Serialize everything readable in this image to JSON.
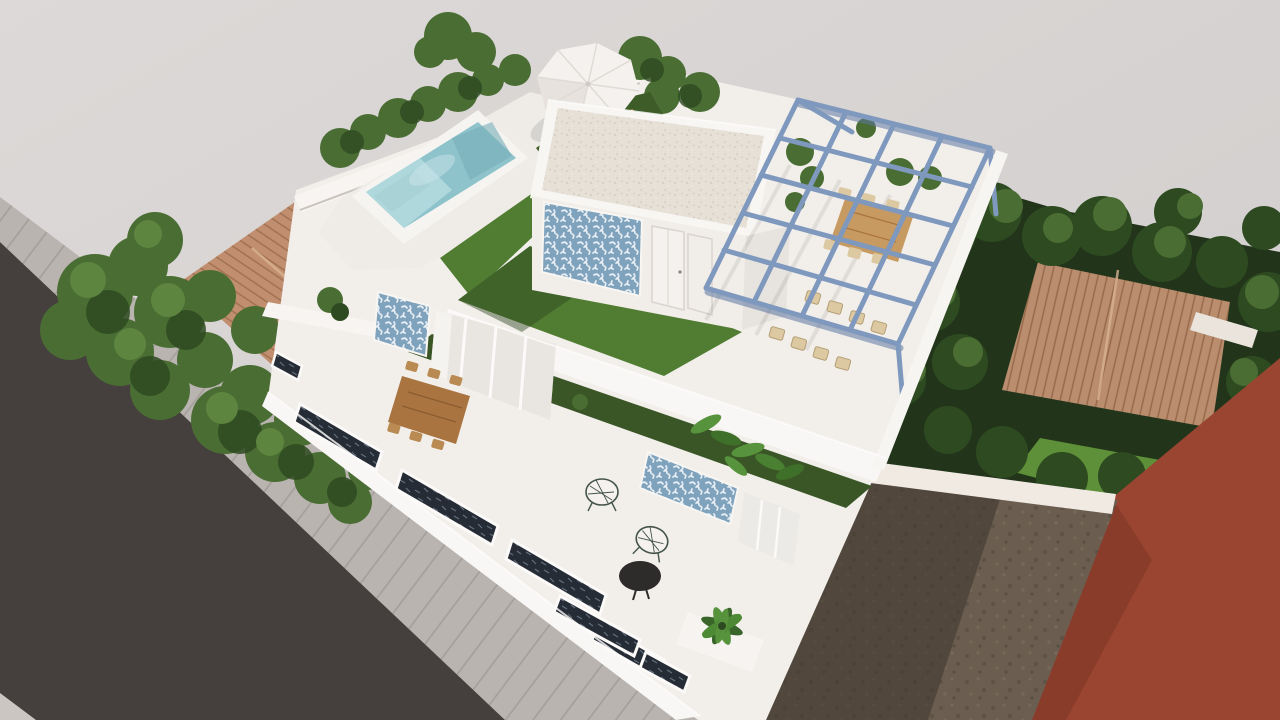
{
  "scene": {
    "background": {
      "top_left": "#dcd9d8",
      "bottom_right": "#d0cccb"
    },
    "street": {
      "road": "#453f3d",
      "sidewalk": "#b9b4b0",
      "sidewalk_stripe": "#a39e9a",
      "curb": "#cbc6c2"
    },
    "villa": {
      "walls": "#f2efeb",
      "walls_bright": "#f9f7f5",
      "walls_shade": "#e7e3de",
      "roof_gravel": "#e6e0d7",
      "tile_panel_base": "#7fa2bd",
      "tile_panel_motif": "#edf3f6",
      "door": "#f4f1ee",
      "window_dark": "#262c35",
      "window_streak": "#93a3b8"
    },
    "pool": {
      "water": "#8fc3cb",
      "water_light": "#b7dde1",
      "water_dark": "#74aeb8",
      "coping": "#f6f4f1",
      "steps": "#a9d2d6"
    },
    "garden": {
      "lawn": "#517d33",
      "lawn_shade": "#3d5c28",
      "lawn_bright": "#5d9038",
      "planter": "#3a5626",
      "tree_dark": "#2d4a20",
      "tree_mid": "#4a6d33",
      "tree_light": "#5d8540",
      "garden_dark": "#22351b"
    },
    "pergola": {
      "frame": "#7f98bd",
      "frame_shade": "#5c76a0"
    },
    "furniture": {
      "wood": "#c79a62",
      "wood_dark": "#a9743f",
      "rattan": "#dcc9a2",
      "wire_chair": "#44544a",
      "table_black": "#2e2c2a",
      "umbrella": "#f4f1ee",
      "umbrella_seam": "#dedad5",
      "lounger": "#c08a4e"
    },
    "neighbors": {
      "roof_left": "#c18f6f",
      "roof_left_line": "#9e6f4f",
      "roof_right": "#b98d6e",
      "roof_right_line": "#96684a",
      "red_wall": "#9a4531",
      "red_wall_shade": "#7c3424",
      "dirt": "#6b5e50",
      "dirt_shadow": "#3c342d"
    }
  }
}
